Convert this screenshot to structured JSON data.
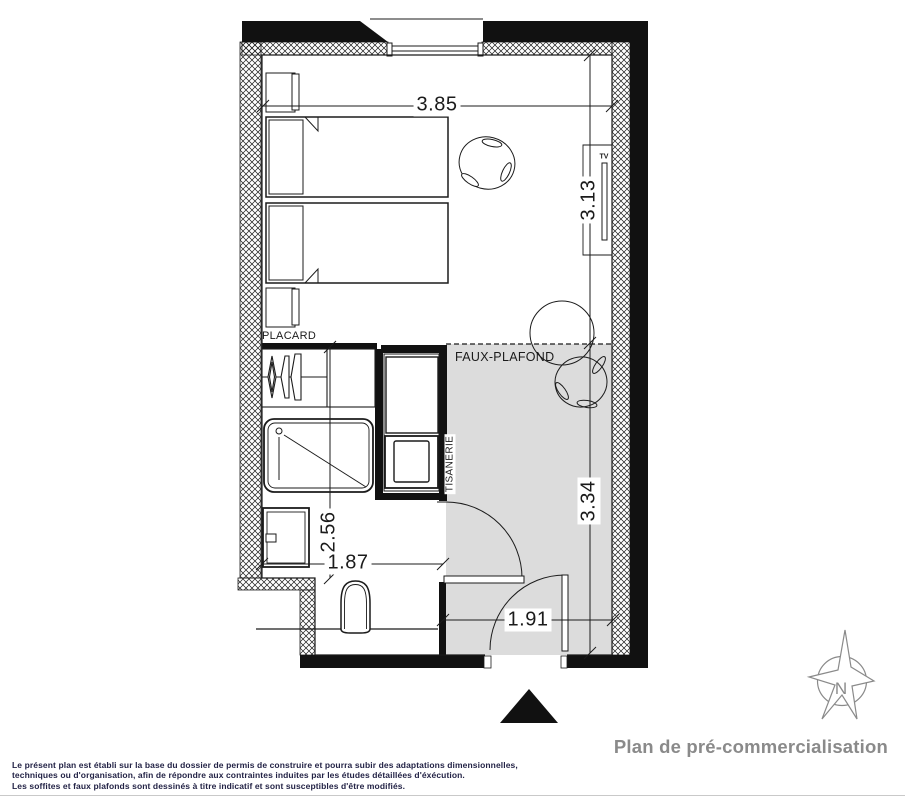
{
  "plan": {
    "dims": {
      "top_width": "3.85",
      "right_upper": "3.13",
      "right_lower": "3.34",
      "bath_height": "2.56",
      "bath_width": "1.87",
      "hall_width": "1.91"
    },
    "labels": {
      "closet": "PLACARD",
      "false_ceiling": "FAUX-PLAFOND",
      "kitchenette": "TISANERIE",
      "tv": "TV",
      "north": "N"
    }
  },
  "footer": {
    "title": "Plan de pré-commercialisation",
    "disclaimer": [
      "Le présent plan est établi sur la base du dossier de permis de construire et pourra subir des adaptations dimensionnelles,",
      "techniques ou d'organisation, afin de répondre aux contraintes induites par les études détaillées d'éxécution.",
      "Les soffites et faux plafonds sont dessinés à titre indicatif et sont susceptibles d'être modifiés."
    ]
  },
  "colors": {
    "ink": "#1b1b1b",
    "room_gray": "#dcdcdc",
    "muted": "#8a8a8a",
    "note_ink": "#232346"
  }
}
